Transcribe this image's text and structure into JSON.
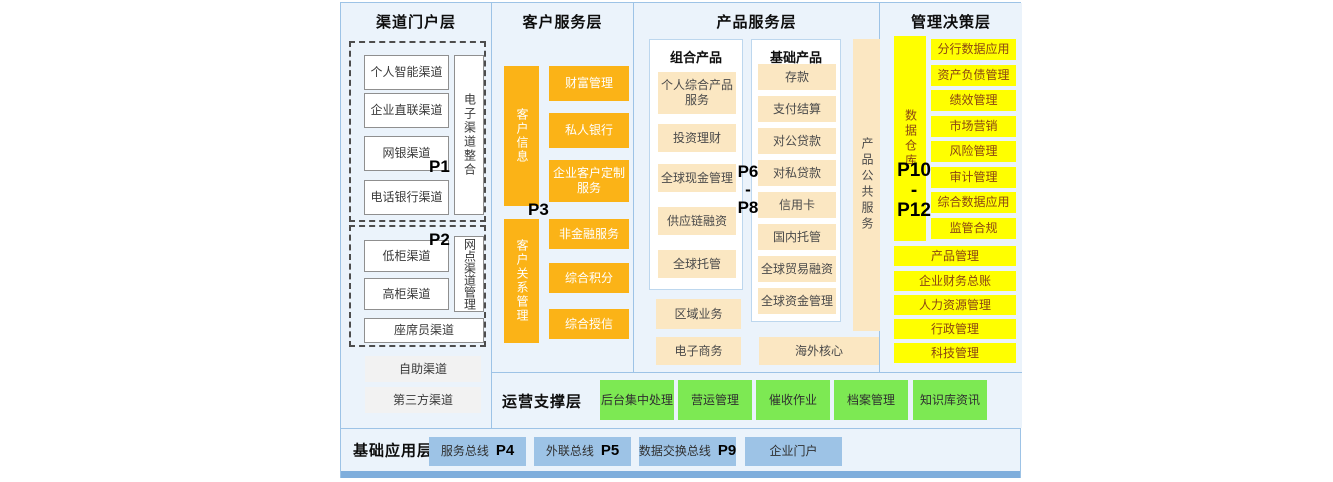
{
  "layers": {
    "channel": {
      "title": "渠道门户层",
      "group1": {
        "p_label": "P1",
        "items": [
          "个人智能渠道",
          "企业直联渠道",
          "网银渠道",
          "电话银行渠道"
        ],
        "side": "电子渠道整合"
      },
      "group2": {
        "p_label": "P2",
        "items": [
          "低柜渠道",
          "高柜渠道"
        ],
        "side": "网点渠道管理",
        "bottom": "座席员渠道"
      },
      "extras": [
        "自助渠道",
        "第三方渠道"
      ]
    },
    "customer": {
      "title": "客户服务层",
      "p_label": "P3",
      "group1": {
        "bar": "客户信息",
        "items": [
          "财富管理",
          "私人银行",
          "企业客户定制服务"
        ]
      },
      "group2": {
        "bar": "客户关系管理",
        "items": [
          "非金融服务",
          "综合积分",
          "综合授信"
        ]
      }
    },
    "product": {
      "title": "产品服务层",
      "p_label_top": "P6",
      "p_label_sep": "-",
      "p_label_bottom": "P8",
      "combo": {
        "title": "组合产品",
        "items": [
          "个人综合产品服务",
          "投资理财",
          "全球现金管理",
          "供应链融资",
          "全球托管"
        ]
      },
      "basic": {
        "title": "基础产品",
        "items": [
          "存款",
          "支付结算",
          "对公贷款",
          "对私贷款",
          "信用卡",
          "国内托管",
          "全球贸易融资",
          "全球资金管理"
        ]
      },
      "side": "产品公共服务",
      "bottom_left": [
        "区域业务",
        "电子商务"
      ],
      "bottom_right": "海外核心"
    },
    "management": {
      "title": "管理决策层",
      "p_label_top": "P10",
      "p_label_sep": "-",
      "p_label_bottom": "P12",
      "bar": "数据仓库",
      "items": [
        "分行数据应用",
        "资产负债管理",
        "绩效管理",
        "市场营销",
        "风险管理",
        "审计管理",
        "综合数据应用",
        "监管合规"
      ],
      "wide_items": [
        "产品管理",
        "企业财务总账",
        "人力资源管理",
        "行政管理",
        "科技管理"
      ]
    },
    "operations": {
      "title": "运营支撑层",
      "items": [
        "后台集中处理",
        "营运管理",
        "催收作业",
        "档案管理",
        "知识库资讯"
      ]
    },
    "foundation": {
      "title": "基础应用层",
      "items": [
        {
          "label": "服务总线",
          "p_label": "P4"
        },
        {
          "label": "外联总线",
          "p_label": "P5"
        },
        {
          "label": "数据交换总线",
          "p_label": "P9"
        },
        {
          "label": "企业门户",
          "p_label": ""
        }
      ]
    }
  },
  "colors": {
    "orange": "#FBB317",
    "cream": "#FBE7C2",
    "yellow": "#FFFF00",
    "green": "#7DE953",
    "blue_box": "#9DC3E6",
    "panel_background": "#EBF3FB",
    "border": "#9DC3E6",
    "bottom_strip": "#7FAEDC"
  }
}
